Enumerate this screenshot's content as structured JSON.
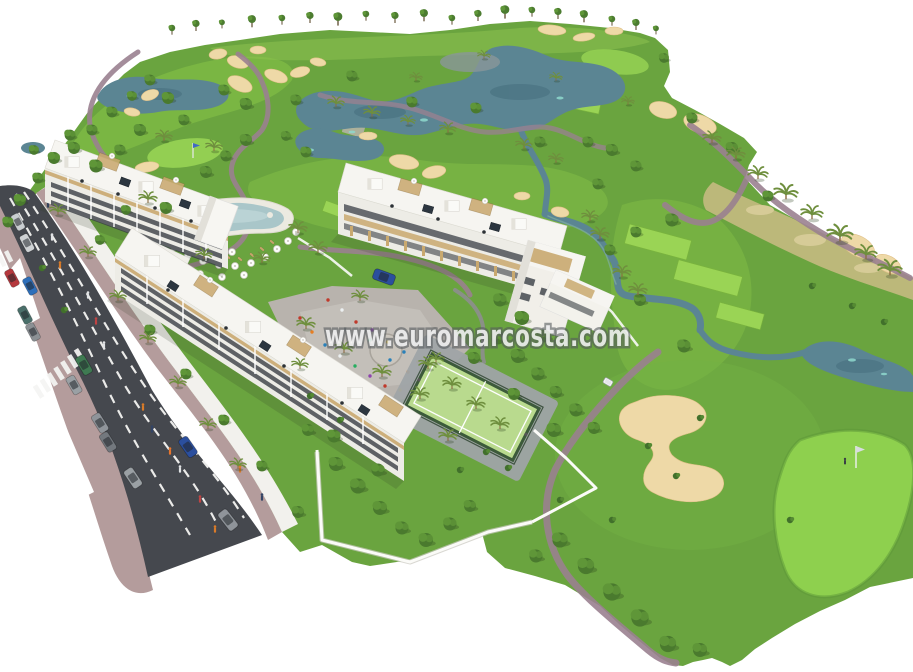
{
  "image": {
    "kind": "architectural-aerial-render",
    "description": "Aerial 3D render of a white apartment complex with swimming pool, central plaza and padel court beside a golf course with lakes, sand bunkers and palm trees; a road with parked cars runs along the left edge",
    "width": 913,
    "height": 672
  },
  "watermark": {
    "text": "www.euromarcosta.com"
  },
  "palette": {
    "bg": "#ffffff",
    "grass": "#6aa43f",
    "fairway": "#80bc46",
    "green-bright": "#93cf52",
    "tee": "#9ad455",
    "water": "#5b8593",
    "water-dark": "#47707f",
    "water-light": "#8fd9ce",
    "sand": "#eed9a7",
    "path": "#9a8190",
    "asphalt": "#45484e",
    "sidewalk-pink": "#b49c9c",
    "sidewalk-light": "#f2f1ed",
    "building": "#f6f5f1",
    "facade": "#edece6",
    "wood": "#c9a96f",
    "window": "#3a3f45",
    "tree": "#4a7a2e",
    "tree-light": "#5f9638",
    "palm-frond": "#6f8f3e",
    "arid": "#bcb87a",
    "court": "#b9da8e",
    "plaza": "#b8b3ad",
    "pool": "#a9c6c9"
  },
  "scene": {
    "features": [
      "golf-course",
      "lakes",
      "sand-bunkers",
      "cart-paths",
      "putting-greens",
      "tee-boxes",
      "apartment-buildings",
      "rooftop-terraces",
      "swimming-pool",
      "parasols",
      "central-plaza",
      "padel-court",
      "gardens",
      "road",
      "crosswalks",
      "parked-cars",
      "pedestrians",
      "palm-trees",
      "golf-flag",
      "golfer",
      "golf-cart",
      "watermark"
    ]
  }
}
